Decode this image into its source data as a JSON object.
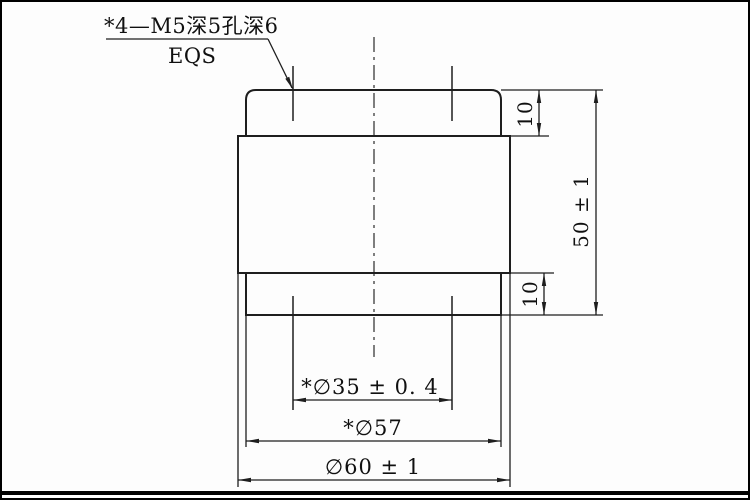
{
  "drawing": {
    "note": {
      "line1": "*4—M5深5孔深6",
      "line2": "EQS"
    },
    "dimensions": {
      "top_boss_height": "10",
      "overall_height": "50 ± 1",
      "bottom_boss_height": "10",
      "bolt_circle_diameter": "*∅35 ± 0. 4",
      "boss_diameter": "*∅57",
      "body_diameter": "∅60 ± 1"
    },
    "colors": {
      "line": "#1e1e1e",
      "background": "#fdfdfd",
      "frame": "#000000"
    }
  }
}
